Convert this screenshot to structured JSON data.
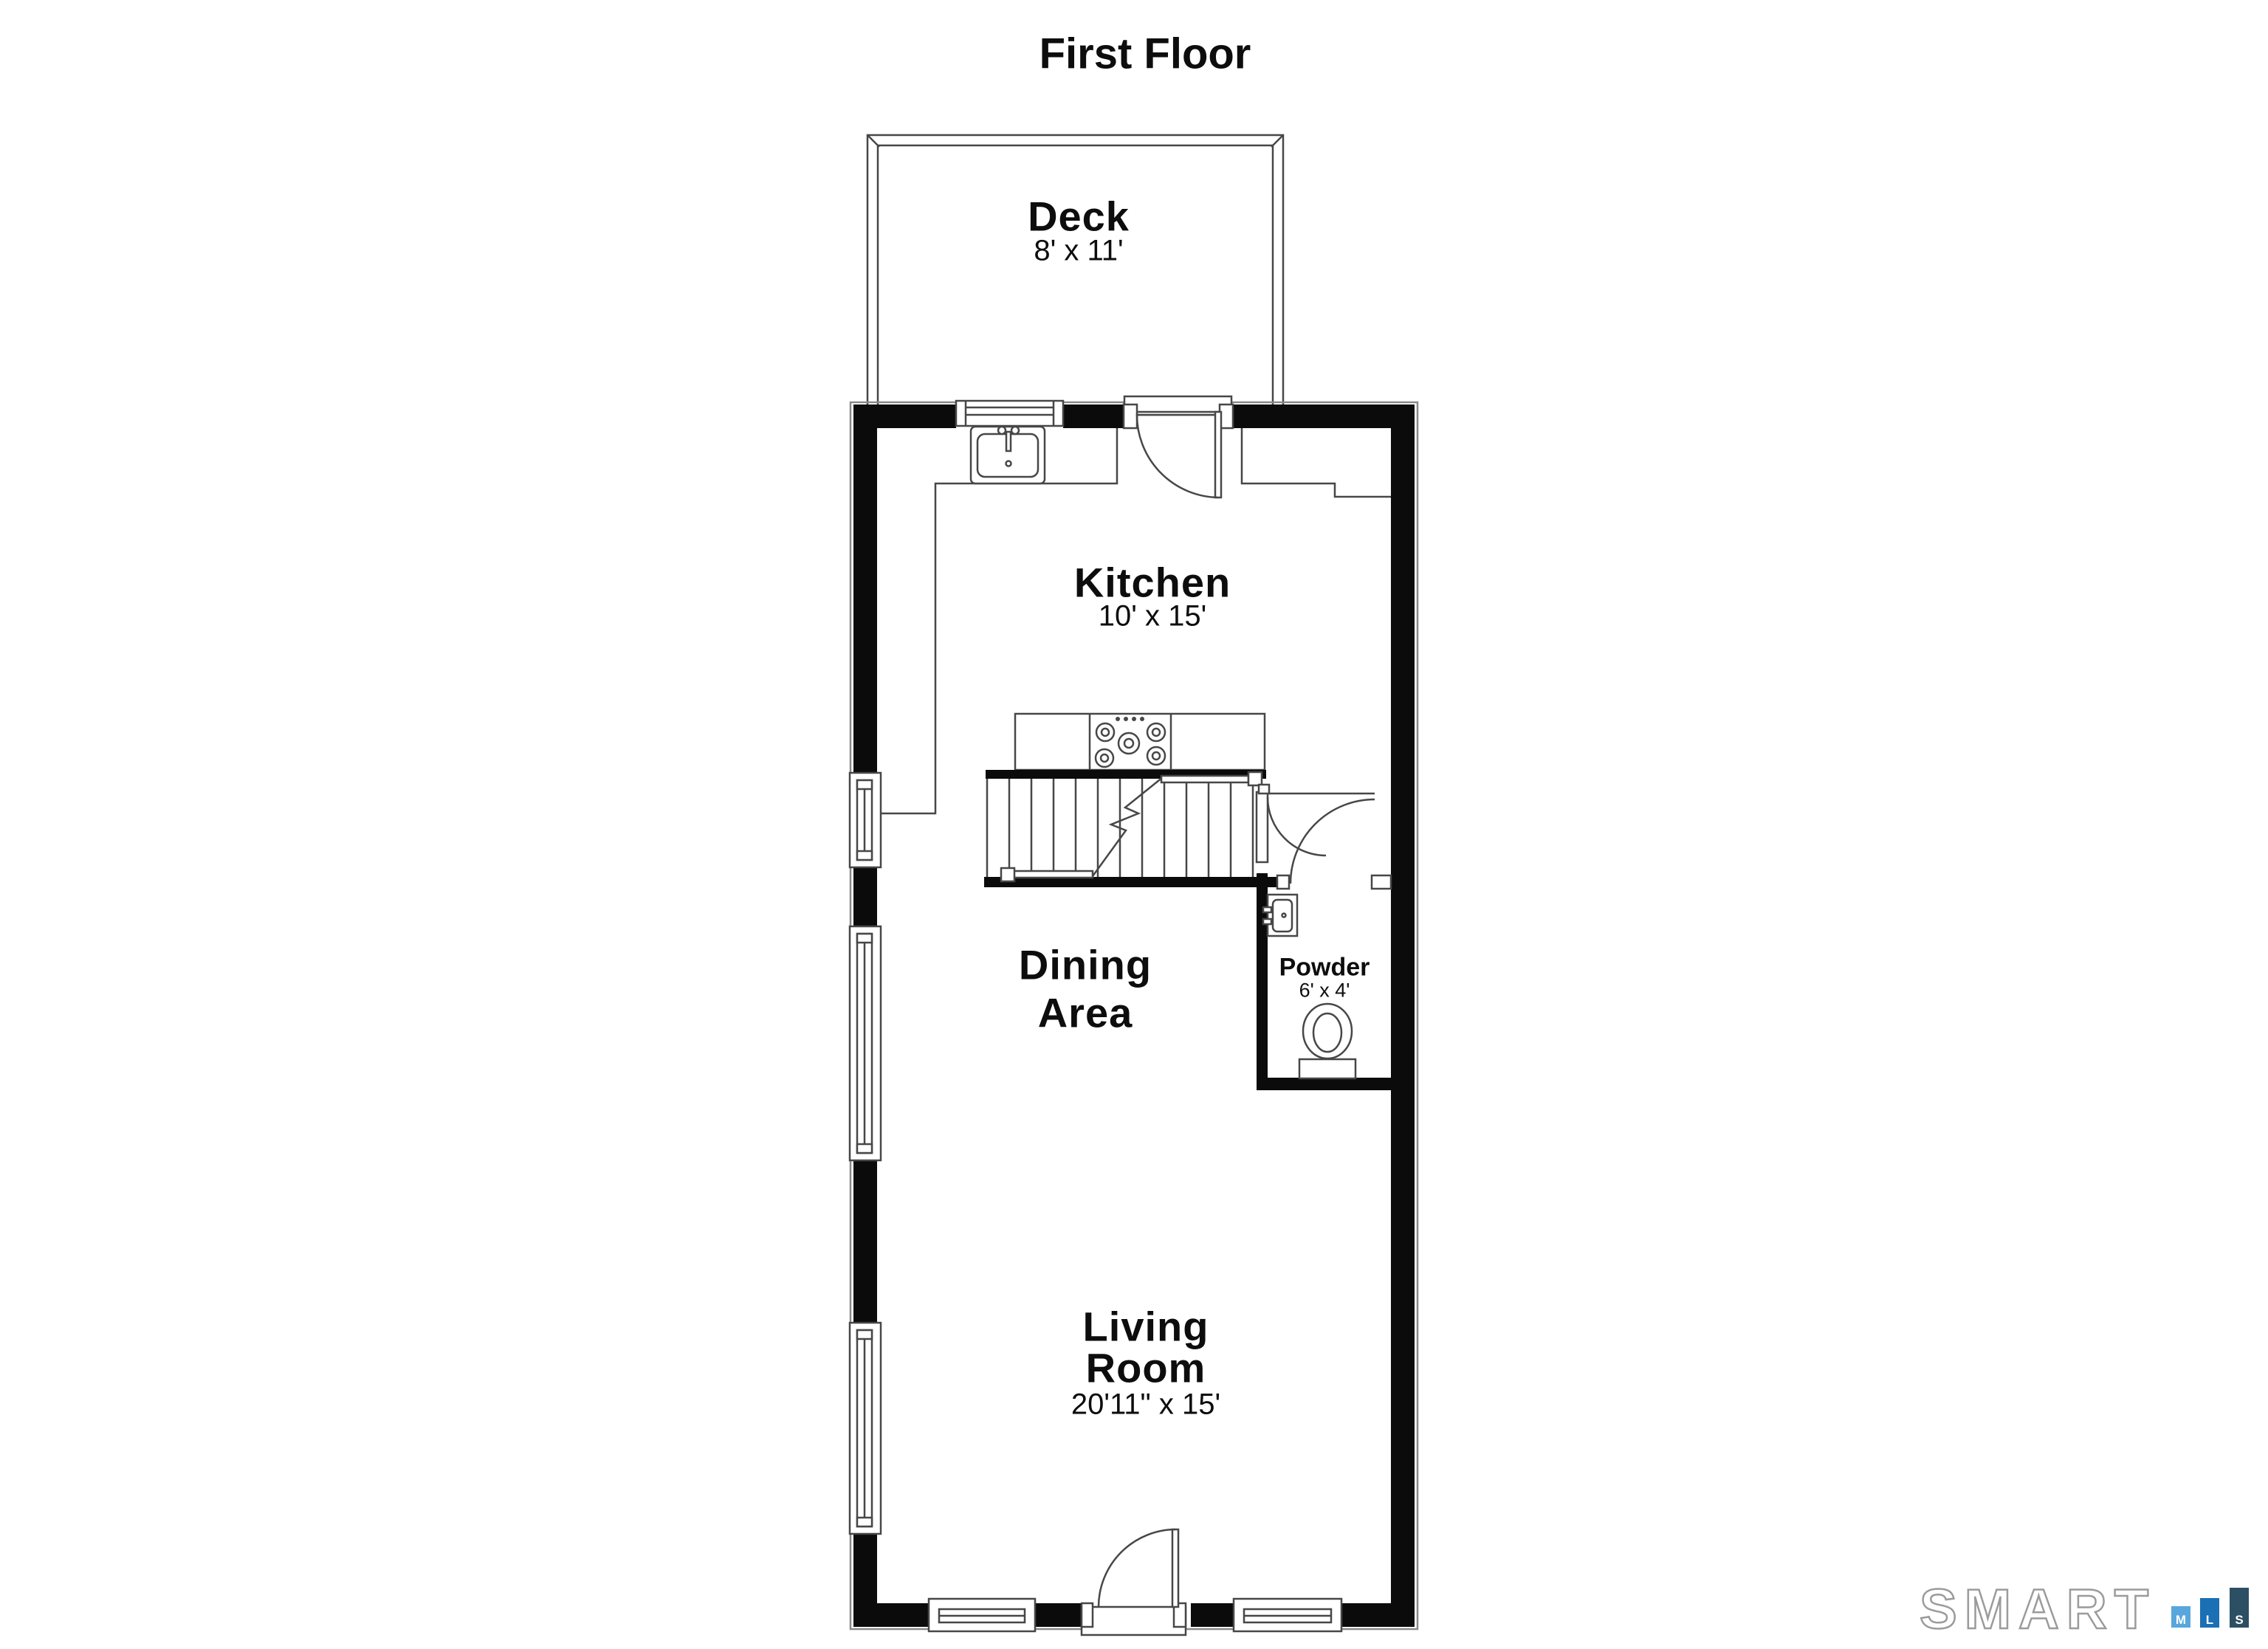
{
  "title": "First Floor",
  "rooms": {
    "deck": {
      "name": "Deck",
      "dims": "8' x 11'"
    },
    "kitchen": {
      "name": "Kitchen",
      "dims": "10' x 15'"
    },
    "dining": {
      "line1": "Dining",
      "line2": "Area"
    },
    "powder": {
      "name": "Powder",
      "dims": "6' x 4'"
    },
    "living": {
      "line1": "Living",
      "line2": "Room",
      "dims": "20'11\" x 15'"
    }
  },
  "logo": {
    "brand": "SMART",
    "outline_color": "#9b9b9b",
    "bars": [
      {
        "letter": "M",
        "color": "#58a7dc"
      },
      {
        "letter": "L",
        "color": "#1b6fb4"
      },
      {
        "letter": "S",
        "color": "#2d4f63"
      }
    ]
  },
  "colors": {
    "wall": "#0b0b0b",
    "line": "#474747",
    "outer_outline": "#8a8a8a"
  }
}
